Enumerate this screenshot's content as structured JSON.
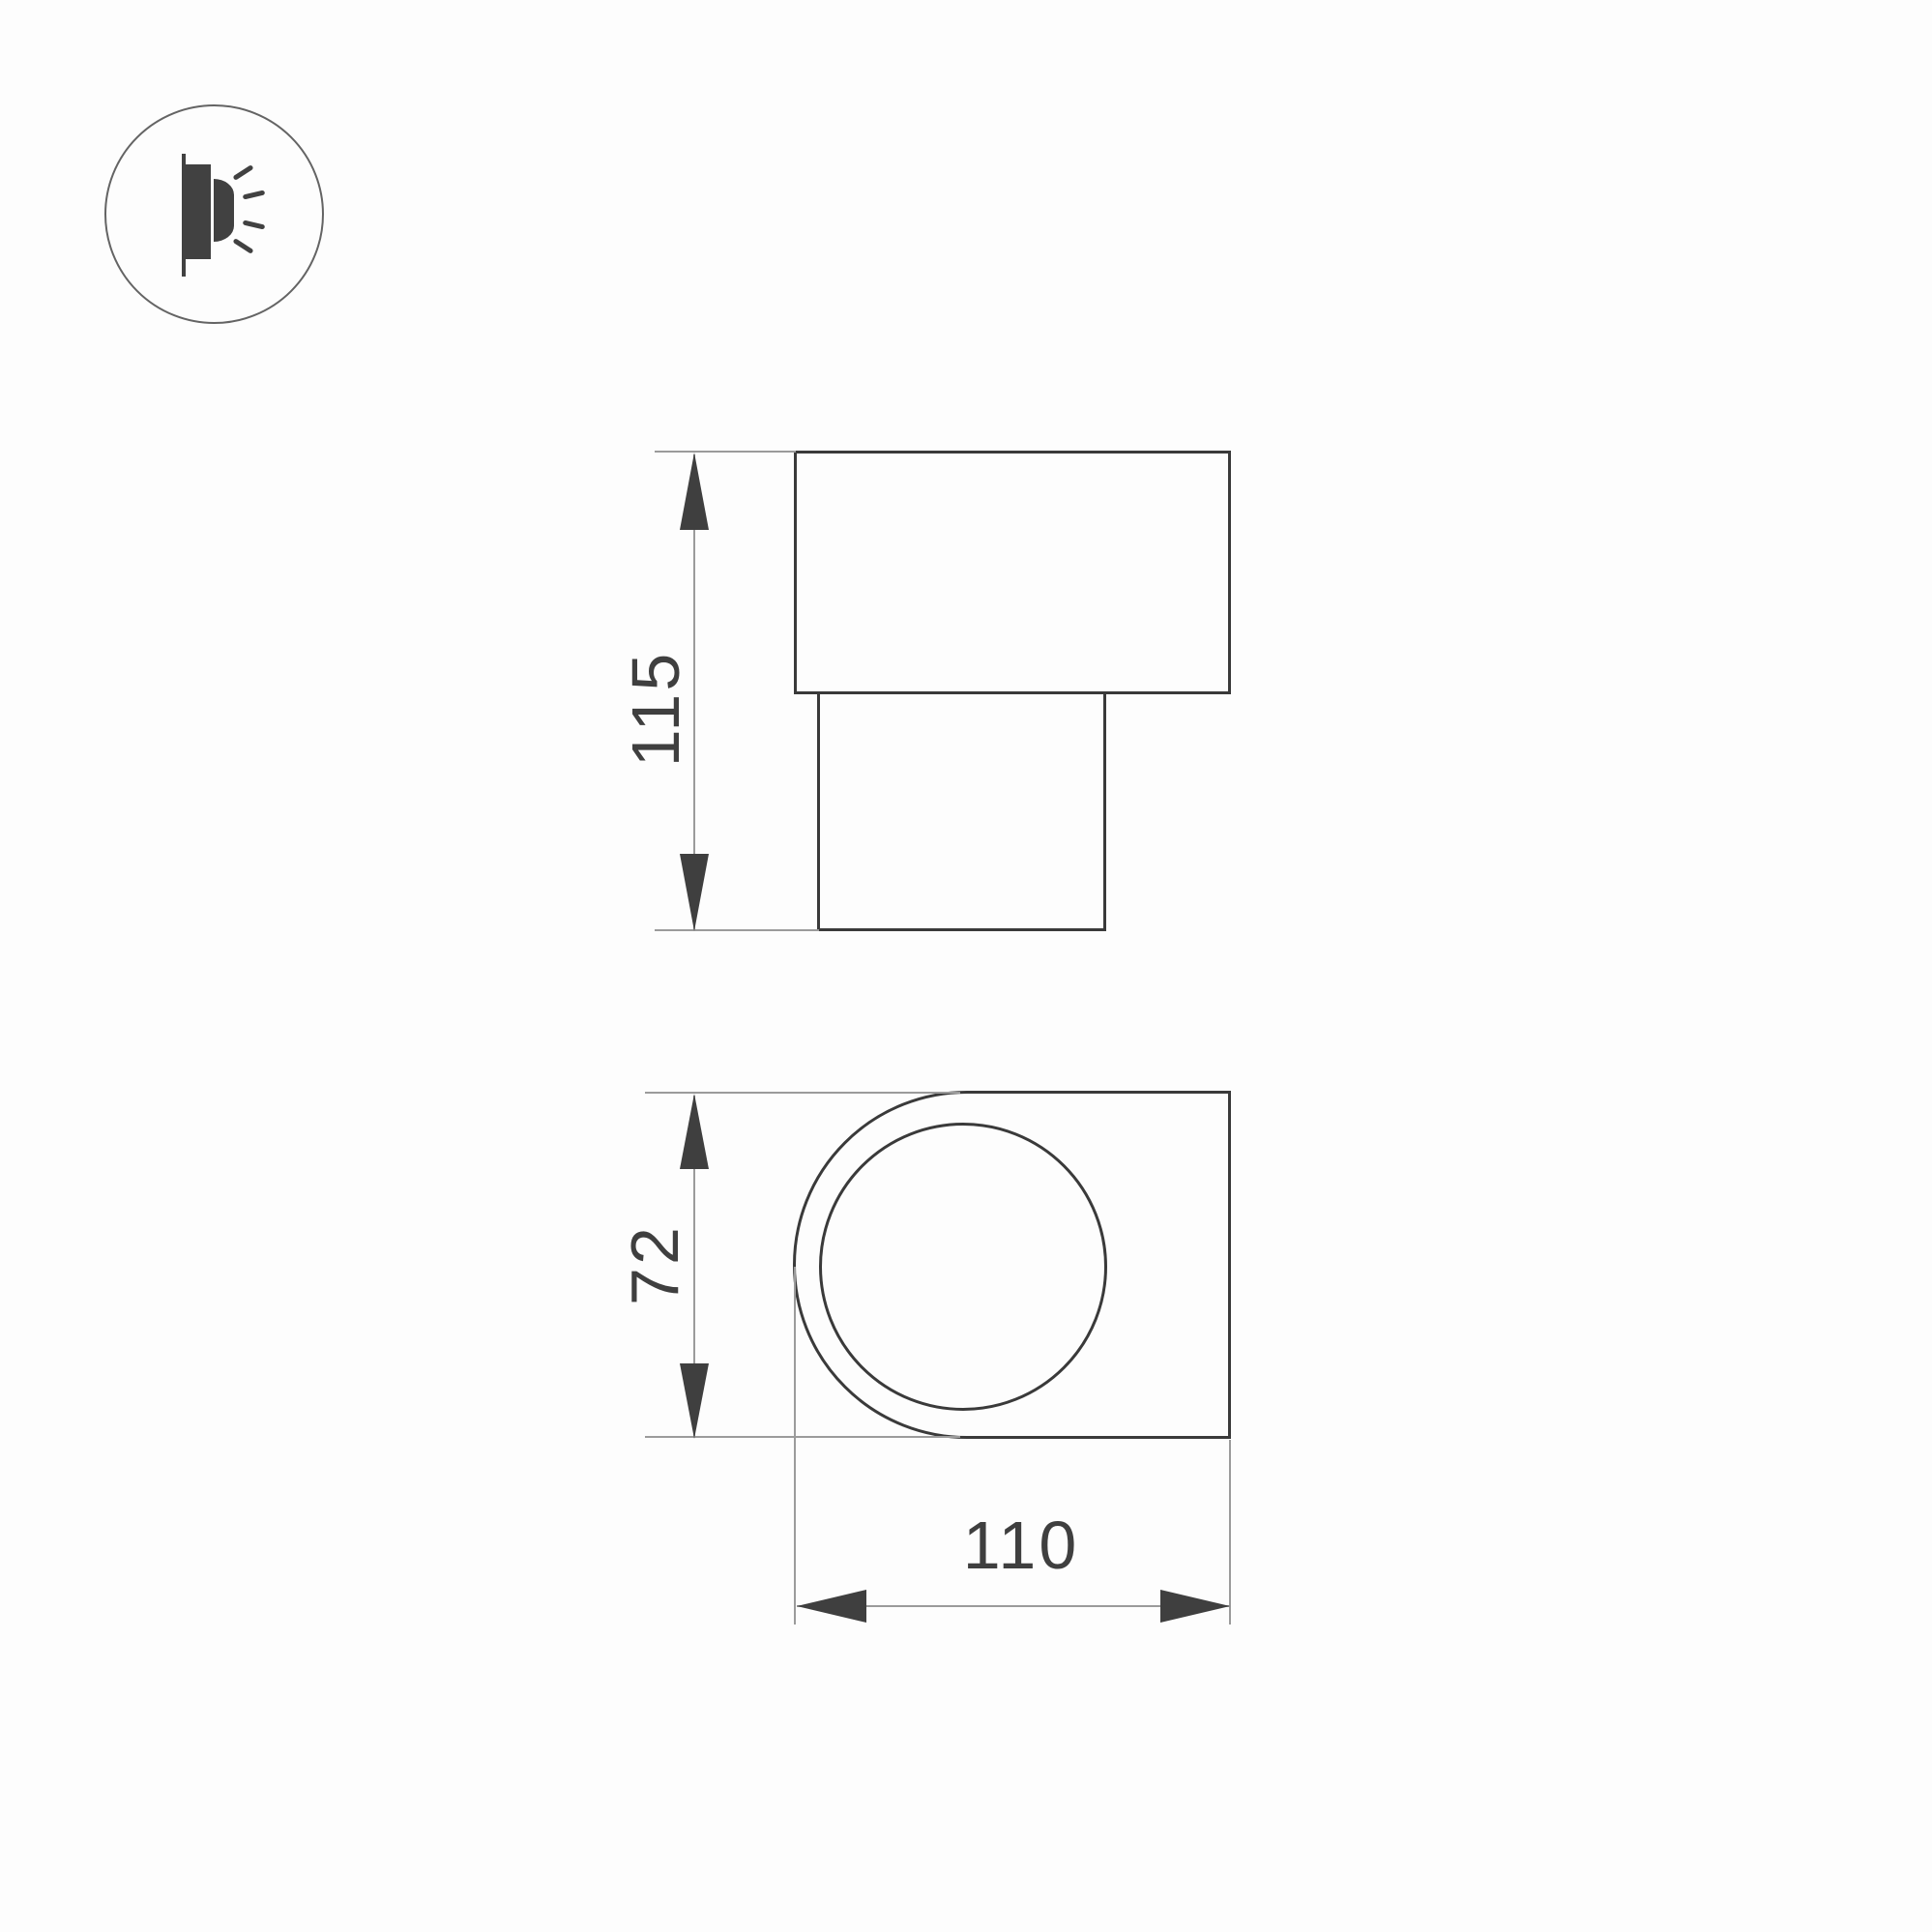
{
  "drawing": {
    "type": "technical-dimension-drawing",
    "background_color": "#fdfdfd",
    "outline_color": "#3a3a3a",
    "thin_line_color": "#9b9b9b",
    "text_color": "#3f3f3f",
    "icon": {
      "name": "wall-light-side-glow-icon",
      "glyph_color": "#414141",
      "circle_color": "#646464"
    },
    "side_view": {
      "height": {
        "value": "115"
      }
    },
    "front_view": {
      "height": {
        "value": "72"
      },
      "width": {
        "value": "110"
      }
    }
  }
}
